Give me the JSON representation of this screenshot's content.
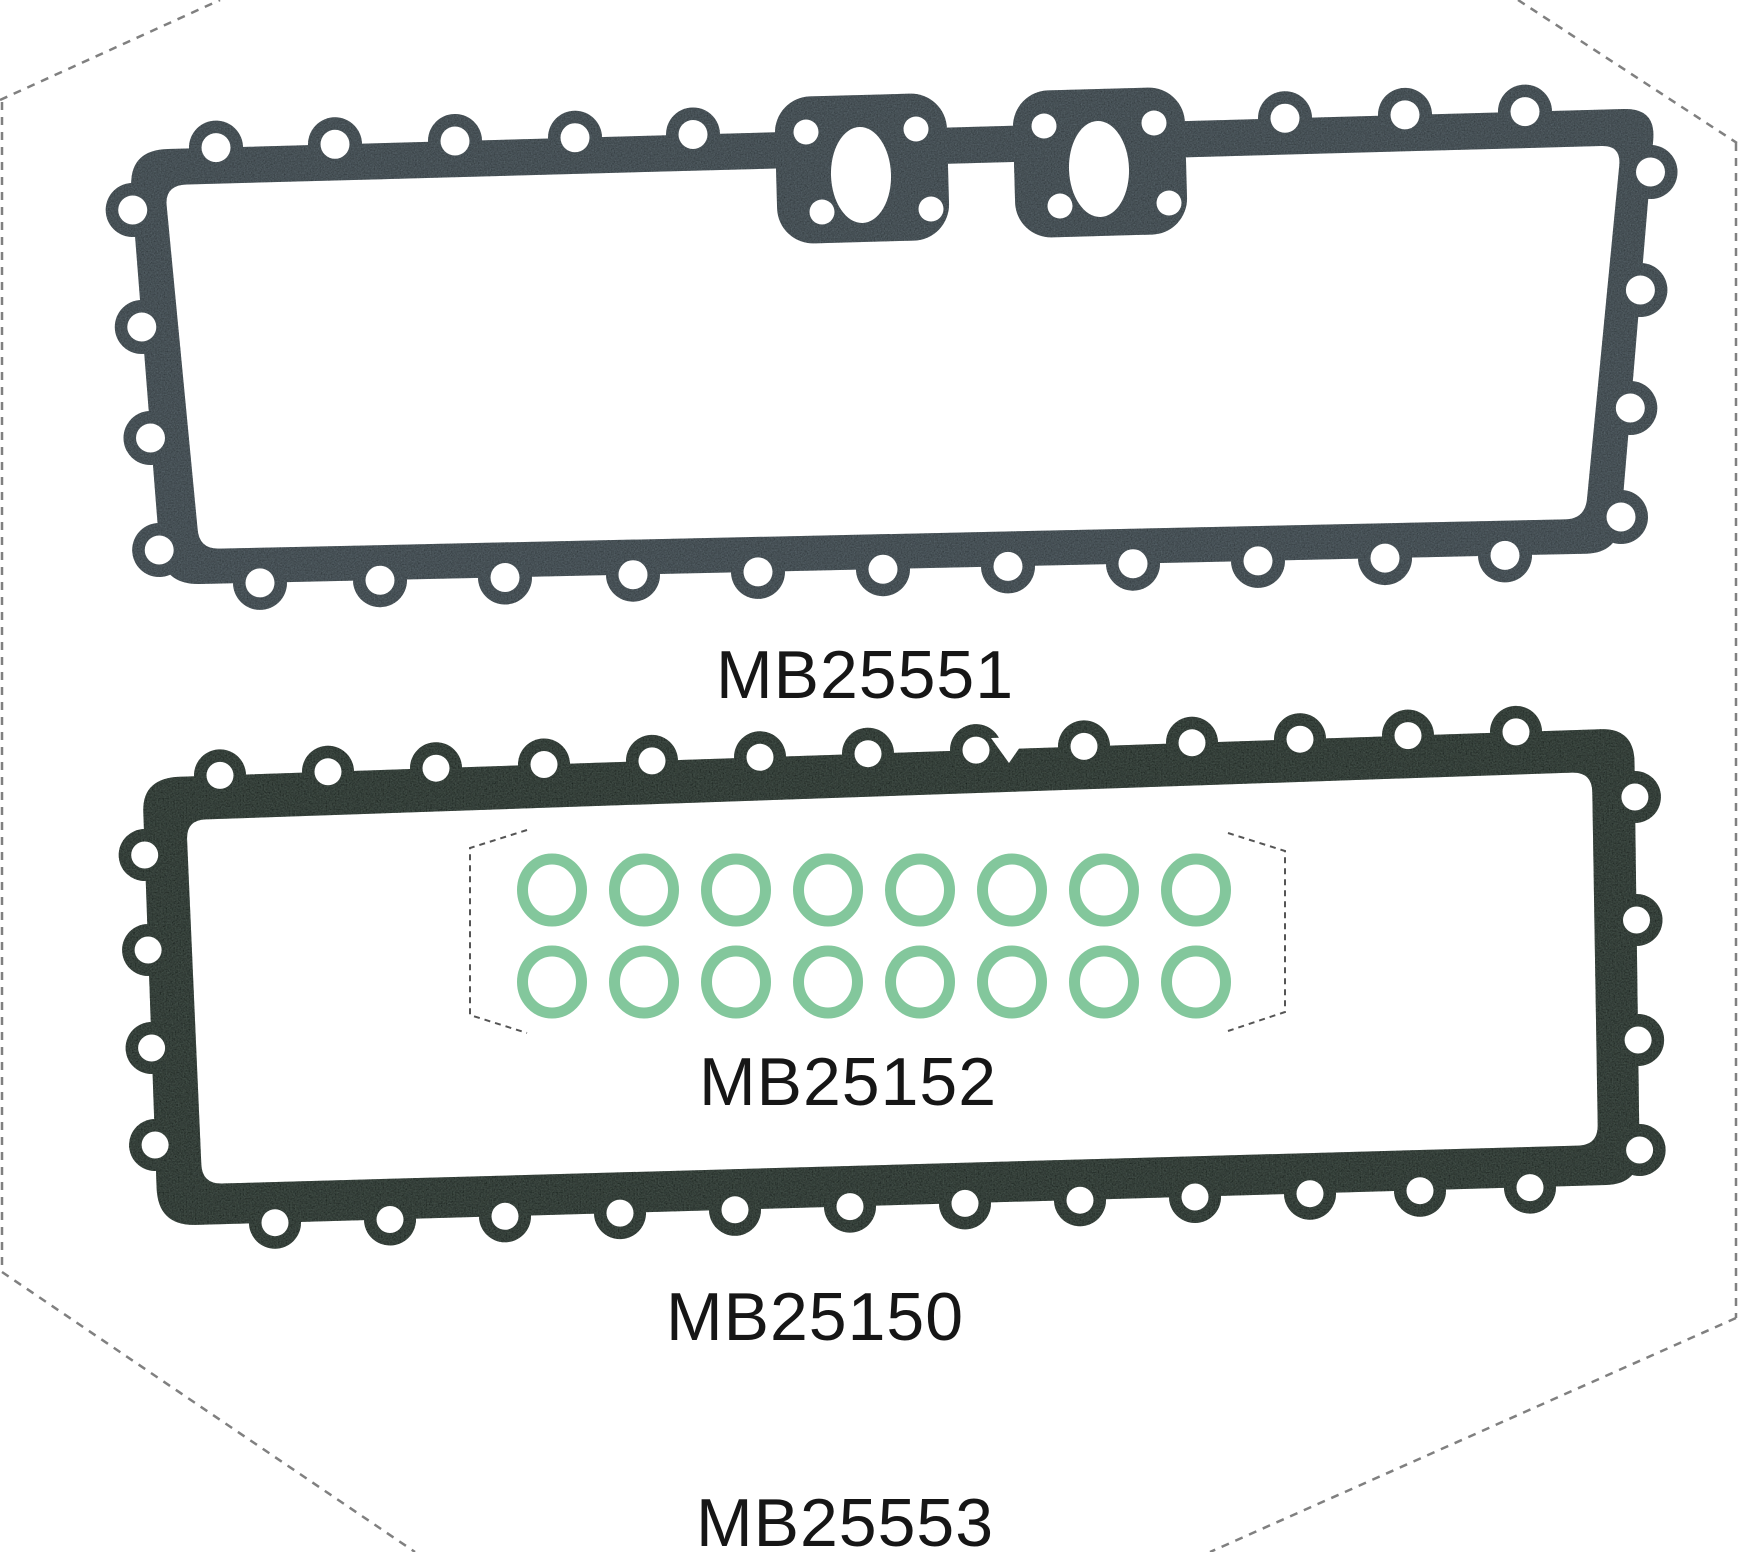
{
  "page": {
    "background": "#ffffff",
    "width": 1738,
    "height": 1552,
    "figure_type": "gasket-set parts illustration with dashed crop outline"
  },
  "labels": {
    "top_gasket": "MB25551",
    "oring_set": "MB25152",
    "bottom_gasket": "MB25150",
    "figure_set": "MB25553"
  },
  "parts": [
    {
      "part_number": "MB25551",
      "appearance": "long slate-gray gasket, bolt holes around perimeter, two oval ports on top edge",
      "color": "#556066"
    },
    {
      "part_number": "MB25152",
      "appearance": "green o-ring set",
      "rings_total": 16,
      "rings_rows": 2,
      "rings_per_row": 8,
      "color": "#83c79c"
    },
    {
      "part_number": "MB25150",
      "appearance": "long dark mottled-green frame gasket, bolt holes around perimeter",
      "color": "#4a574f"
    },
    {
      "part_number": "MB25553",
      "appearance": "part number of the whole pictured set"
    }
  ],
  "colors": {
    "background": "#ffffff",
    "label_text": "#161616",
    "crop_outline_dash": "#808080",
    "oring_region_dash": "#555555",
    "oring_green": "#83c79c",
    "gasket_top": "#556066",
    "gasket_bottom": "#4a574f"
  }
}
